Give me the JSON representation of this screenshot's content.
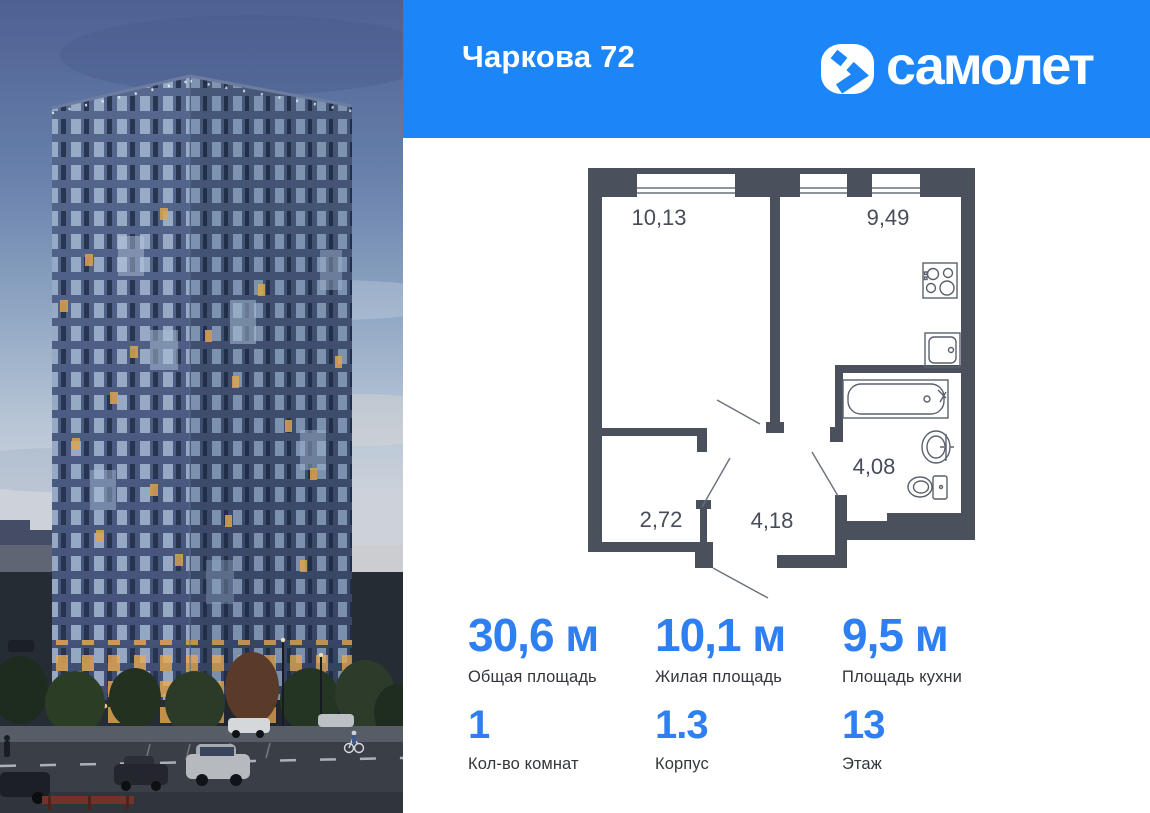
{
  "header": {
    "title": "Чаркова 72",
    "brand_name": "самолет",
    "bg_color": "#1c86f8"
  },
  "icons": {
    "brand_logo": "samolet-chevron-icon"
  },
  "floor_plan": {
    "wall_color": "#4b515c",
    "rooms": [
      {
        "name": "living-room",
        "area_label": "10,13"
      },
      {
        "name": "kitchen",
        "area_label": "9,49"
      },
      {
        "name": "storage",
        "area_label": "2,72"
      },
      {
        "name": "hallway",
        "area_label": "4,18"
      },
      {
        "name": "bathroom",
        "area_label": "4,08"
      }
    ]
  },
  "stats": {
    "accent_color": "#2e7ff1",
    "items": [
      {
        "value": "30,6 м",
        "label": "Общая площадь"
      },
      {
        "value": "10,1 м",
        "label": "Жилая площадь"
      },
      {
        "value": "9,5 м",
        "label": "Площадь кухни"
      },
      {
        "value": "1",
        "label": "Кол-во комнат"
      },
      {
        "value": "1.3",
        "label": "Корпус"
      },
      {
        "value": "13",
        "label": "Этаж"
      }
    ]
  }
}
